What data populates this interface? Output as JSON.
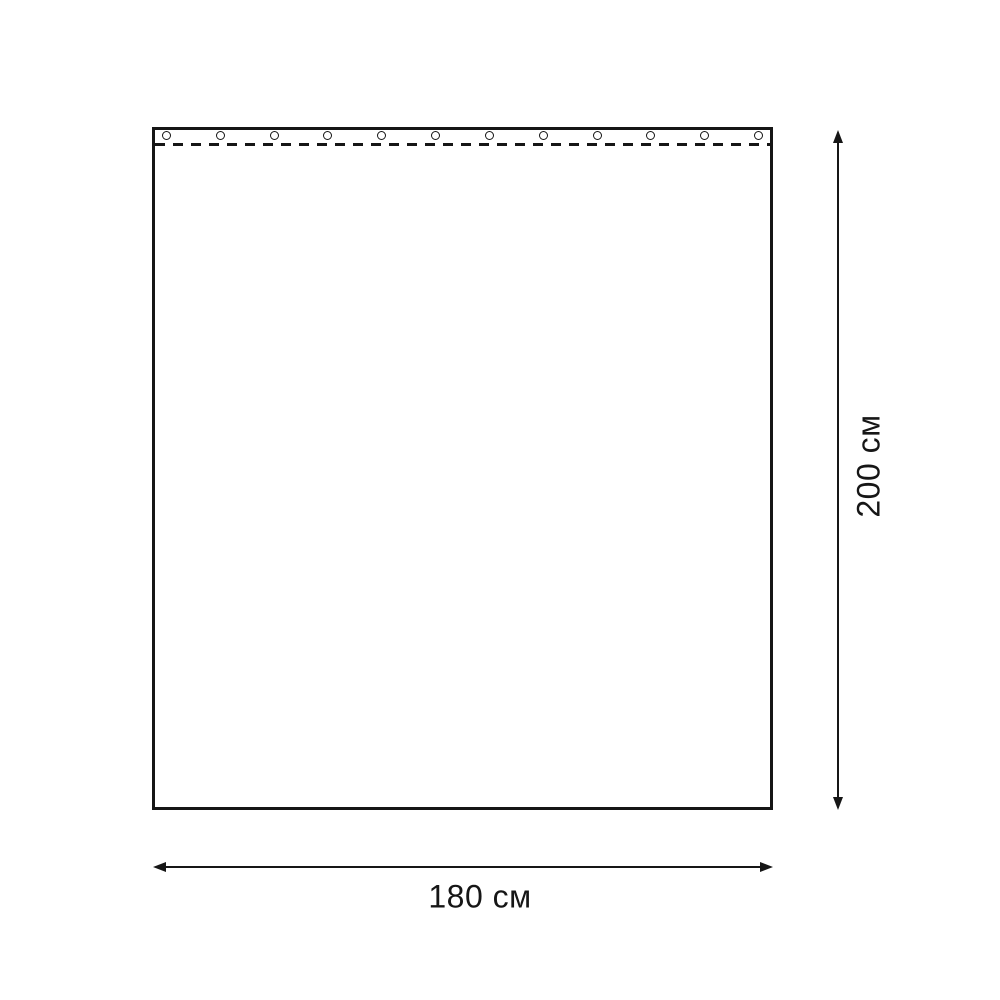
{
  "diagram": {
    "type": "product-dimension-diagram",
    "subject": "curtain panel with grommets and stitch line",
    "curtain": {
      "grommets": {
        "count": 12,
        "shape": "circle"
      },
      "stitch_line_style": "dashed"
    },
    "dimensions": {
      "width_label": "180 см",
      "height_label": "200 см"
    }
  },
  "colors": {
    "line": "#161616",
    "background": "#ffffff"
  },
  "icons": {
    "vertical_dimension": "double-headed-arrow-vertical",
    "horizontal_dimension": "double-headed-arrow-horizontal"
  }
}
